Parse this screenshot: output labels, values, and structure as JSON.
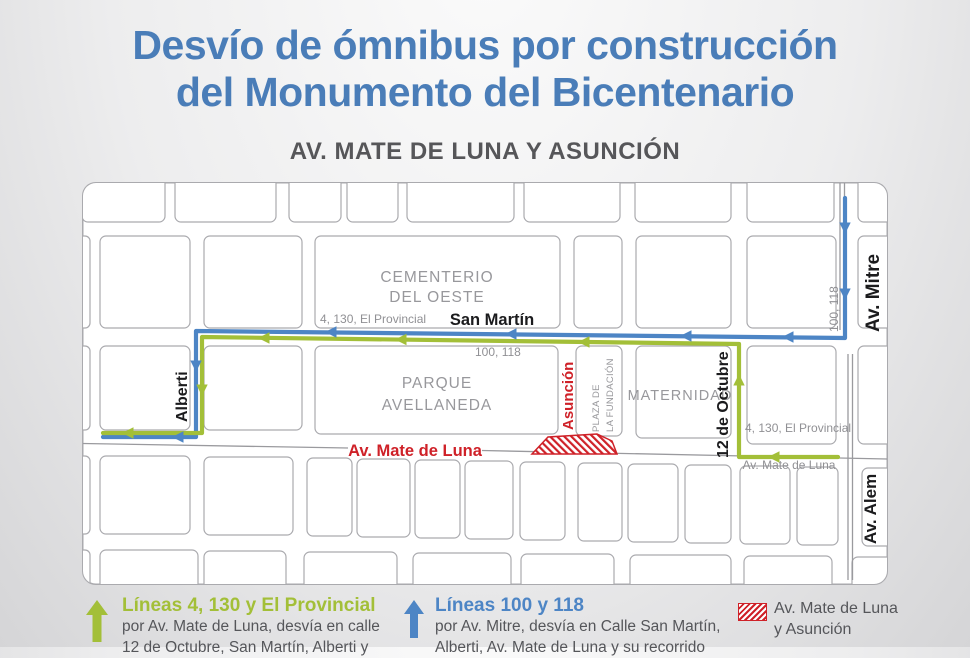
{
  "header": {
    "title_line1": "Desvío de ómnibus por construcción",
    "title_line2": "del Monumento del Bicentenario",
    "subtitle": "AV. MATE DE LUNA Y ASUNCIÓN"
  },
  "map": {
    "places": {
      "cementerio_line1": "CEMENTERIO",
      "cementerio_line2": "DEL OESTE",
      "parque_line1": "PARQUE",
      "parque_line2": "AVELLANEDA",
      "plaza_line1": "PLAZA DE",
      "plaza_line2": "LA FUNDACIÓN",
      "maternidad": "MATERNIDAD"
    },
    "streets": {
      "san_martin": "San Martín",
      "alberti": "Alberti",
      "asuncion": "Asunción",
      "doce_de_octubre": "12 de Octubre",
      "av_mitre": "Av. Mitre",
      "av_alem": "Av. Alem",
      "av_mate_de_luna": "Av. Mate de Luna",
      "av_mate_de_luna_small": "Av. Mate de Luna"
    },
    "route_labels": {
      "green_san_martin": "4, 130, El Provincial",
      "blue_san_martin": "100, 118",
      "blue_mitre": "100, 118",
      "green_12_octubre": "4, 130, El Provincial"
    }
  },
  "legend": {
    "green": {
      "title": "Líneas 4, 130 y El Provincial",
      "line1": "por Av. Mate de Luna, desvía en calle",
      "line2": "12 de Octubre, San Martín, Alberti y"
    },
    "blue": {
      "title": "Líneas 100 y 118",
      "line1": "por Av. Mitre, desvía en Calle San Martín,",
      "line2": "Alberti, Av. Mate de Luna y su recorrido"
    },
    "red": {
      "line1": "Av. Mate de Luna",
      "line2": "y Asunción"
    }
  },
  "colors": {
    "title_blue": "#4a7db8",
    "subtitle_gray": "#565659",
    "route_green": "#a3bf38",
    "route_blue": "#4d85c5",
    "alert_red": "#cf2128",
    "map_label_gray": "#98989c",
    "street_line": "#aaaaae",
    "text_dark": "#55565a"
  }
}
